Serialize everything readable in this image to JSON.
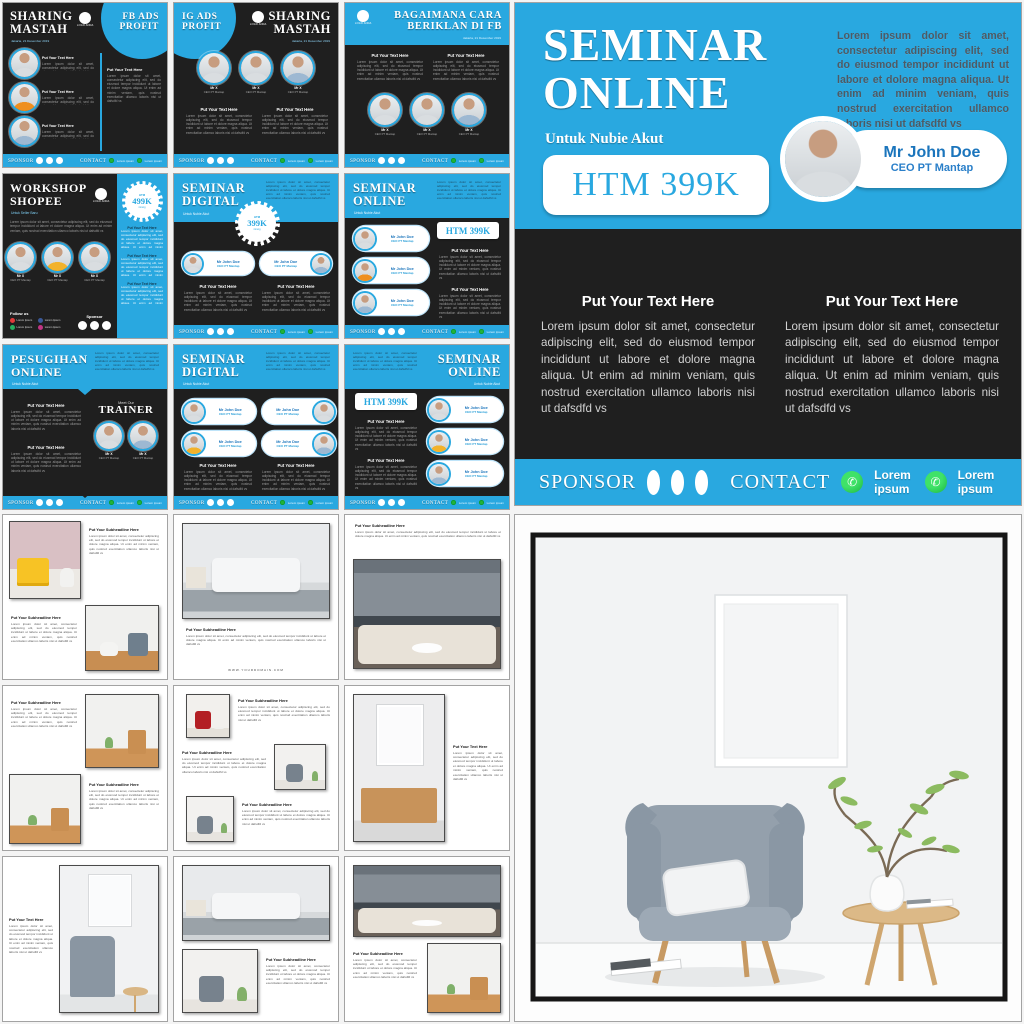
{
  "colors": {
    "blue": "#29a8e0",
    "dark": "#1f1f1f",
    "name_blue": "#1b75bc",
    "whatsapp_green": "#23b33a",
    "badge_yellow": "#f2b22b"
  },
  "common": {
    "pt": "Put Your Text Here",
    "ps": "Put Your Subheadline Here",
    "lor": "Lorem ipsum dolor sit amet, consectetur adipiscing elit, sed do eiusmod tempor incididunt ut labore et dolore magna aliqua. Ut enim ad minim veniam, quis nostrud exercitation ullamco laboris nisi ut dafsdfd vs",
    "mrx": "Mr X",
    "mrj": "Mr John Doe",
    "ceo": "CEO PT Mantap",
    "date": "Jakarta, 21 Desember 2019",
    "logo": "LOGO ANDA",
    "spn": "SPONSOR",
    "cnt": "CONTACT",
    "li": "Lorem ipsum",
    "lii": "Lorem Ipsum",
    "fol": "Follow us",
    "spt": "Sponsor",
    "meet": "Meet Our",
    "trn": "TRAINER",
    "htm": "HTM",
    "org": "/orang",
    "h399": "HTM 399K",
    "k4": "499K",
    "k3": "399K",
    "dom": "WWW.YOURDOMAIN.COM",
    "una": "Untuk Nubie Akut",
    "usb": "Untuk Seller Baru"
  },
  "flyers": [
    {
      "a": "SHARING",
      "b": "MASTAH",
      "c": "FB ADS",
      "d": "PROFIT"
    },
    {
      "a": "IG ADS",
      "b": "PROFIT",
      "c": "SHARING",
      "d": "MASTAH"
    },
    {
      "a": "BAGAIMANA CARA",
      "b": "BERIKLAN DI FB"
    },
    {
      "a": "WORKSHOP",
      "b": "SHOPEE"
    },
    {
      "a": "SEMINAR",
      "b": "DIGITAL"
    },
    {
      "a": "SEMINAR",
      "b": "ONLINE"
    },
    {
      "a": "PESUGIHAN",
      "b": "ONLINE"
    },
    {
      "a": "SEMINAR",
      "b": "DIGITAL"
    },
    {
      "a": "SEMINAR",
      "b": "ONLINE"
    }
  ],
  "big": {
    "a": "SEMINAR",
    "b": "ONLINE"
  }
}
